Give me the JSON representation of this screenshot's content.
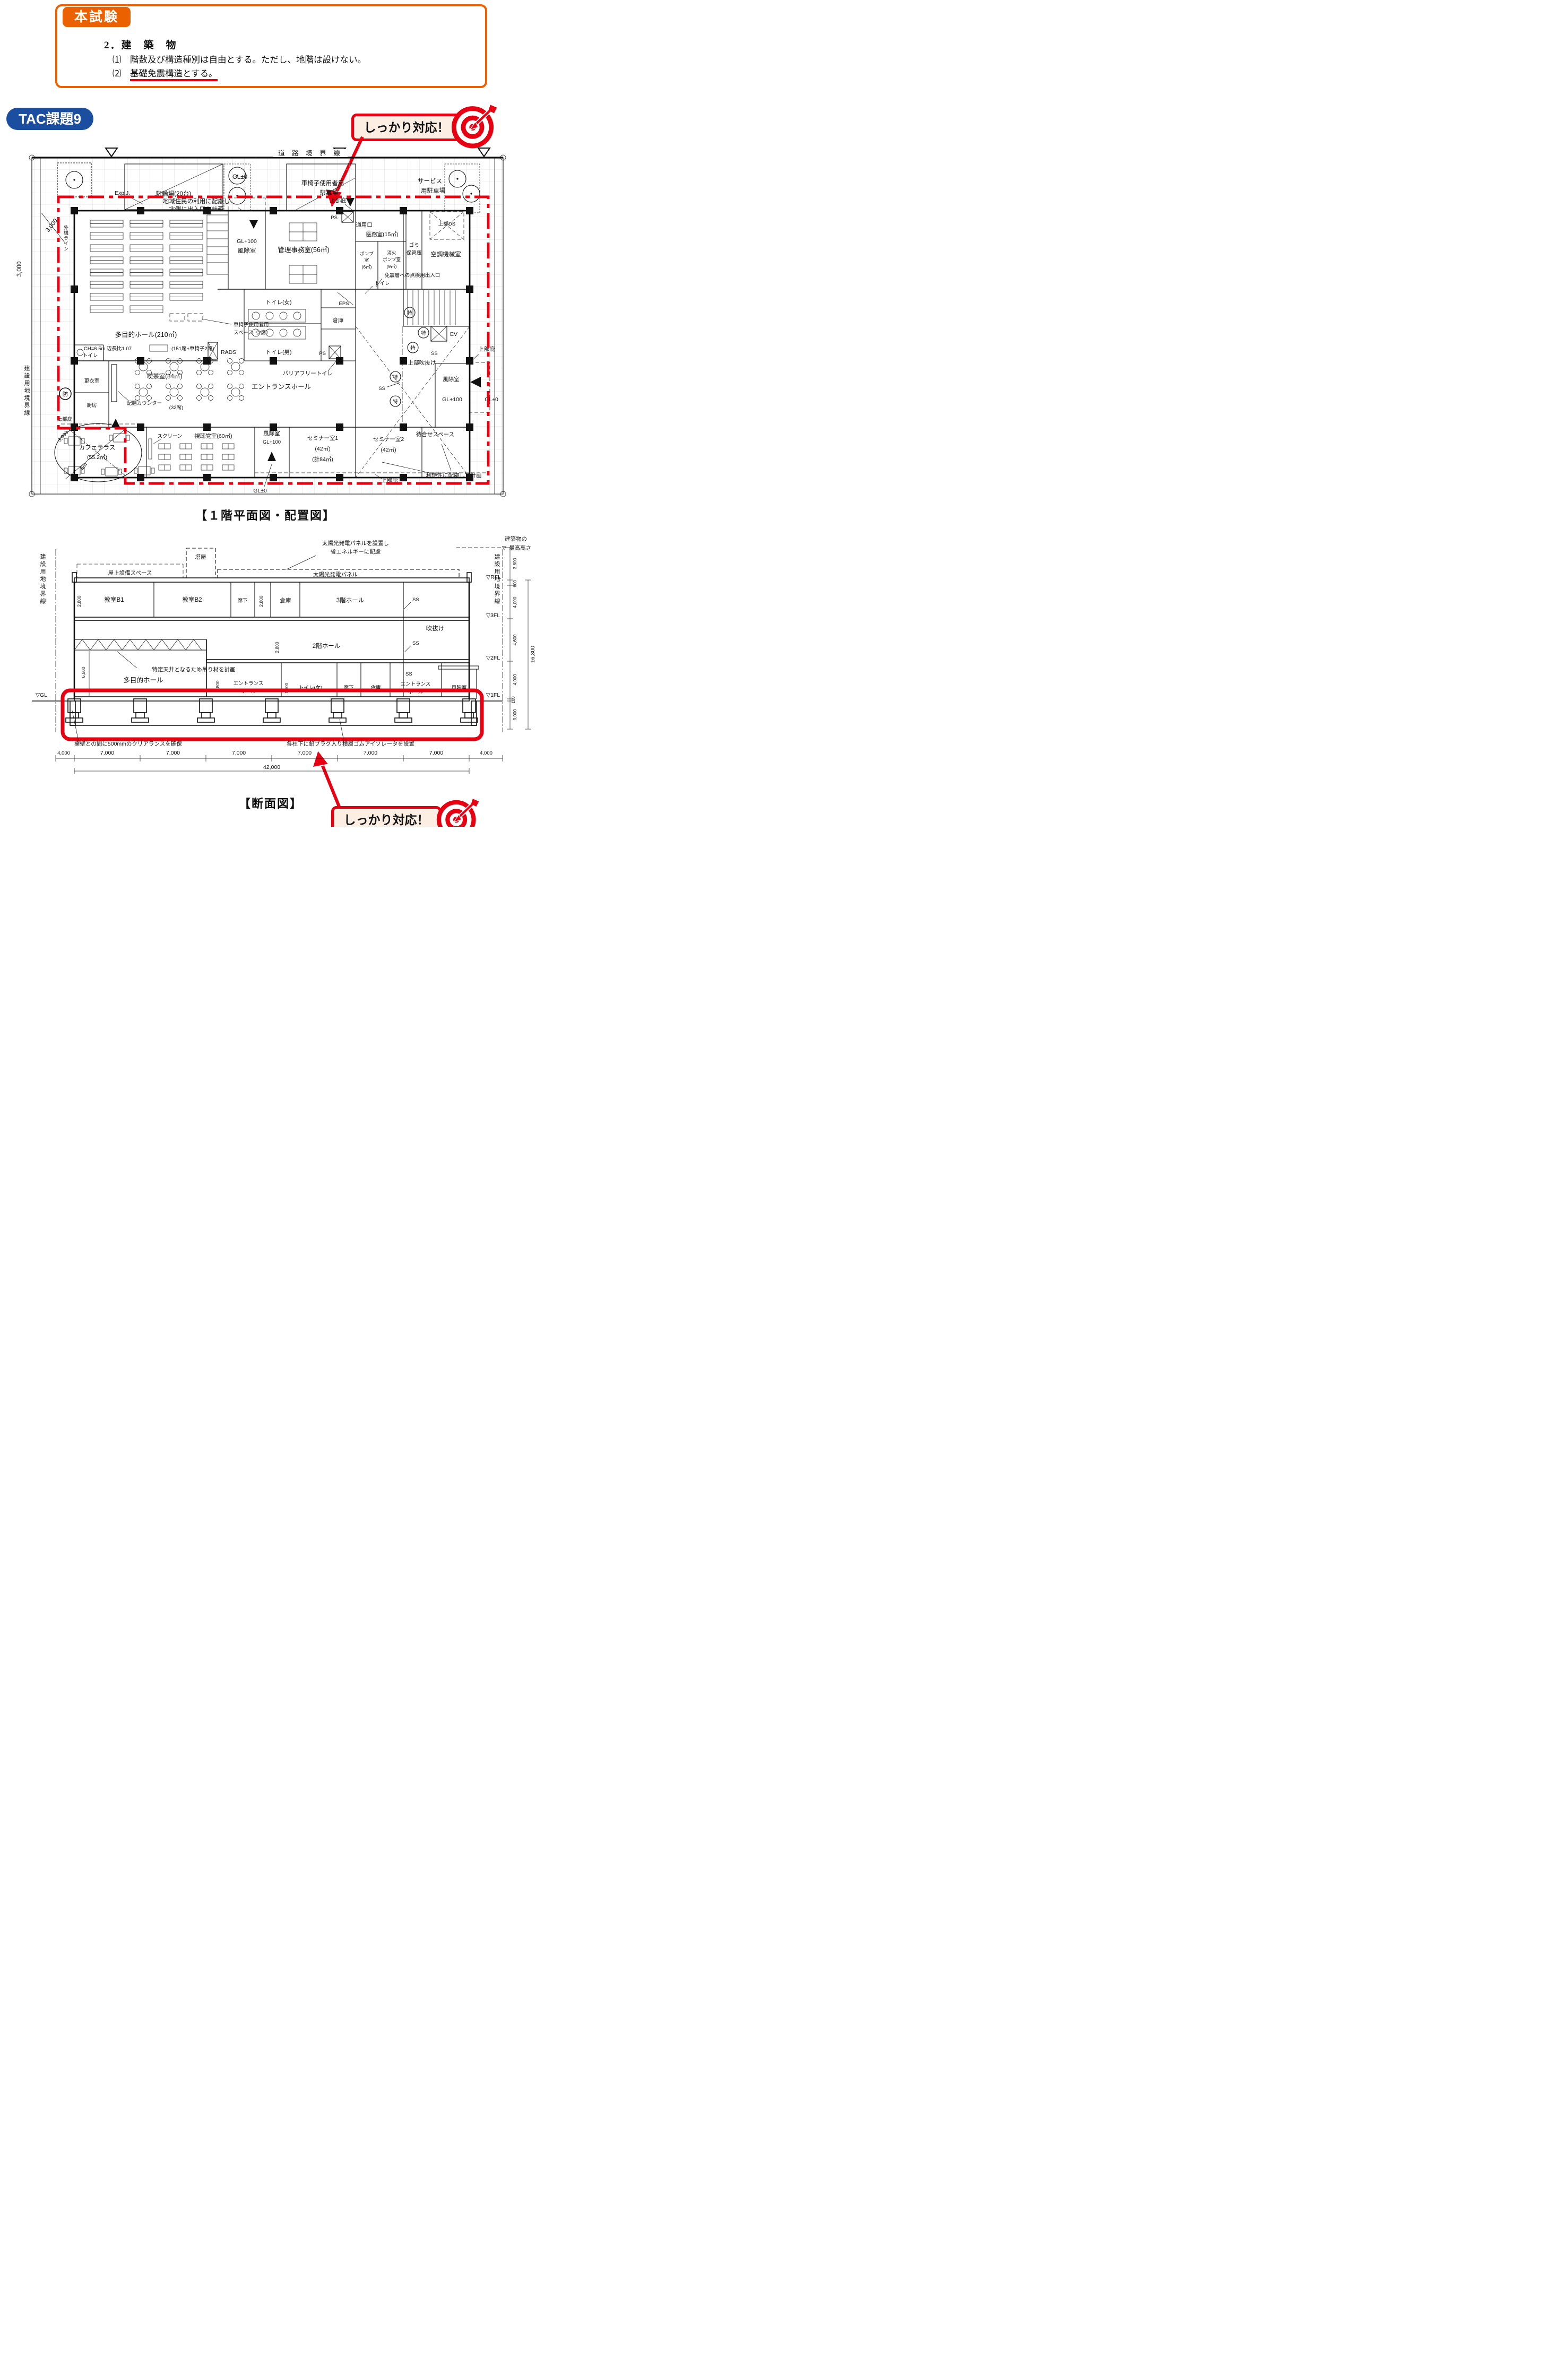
{
  "colors": {
    "orange": "#eb6100",
    "blue": "#1b4e9e",
    "red": "#e60012",
    "cream": "#fdeee4"
  },
  "header": {
    "badge": "本試験",
    "title": "2．建　築　物",
    "item1": "⑴　階数及び構造種別は自由とする。ただし、地階は設けない。",
    "item2_prefix": "⑵　",
    "item2_underlined": "基礎免震構造とする。"
  },
  "badges": {
    "tac": "TAC課題9",
    "callout": "しっかり対応！"
  },
  "shared": {
    "canopy": "上部庇",
    "toku": "特",
    "ss": "SS",
    "gl0": "GL±0",
    "gl100": "GL+100",
    "windbreak": "風除室",
    "storage": "倉庫",
    "corridor": "廊下",
    "ps": "PS",
    "eps": "EPS",
    "ev": "EV",
    "bou": "防",
    "rads": "RADS",
    "toilet": "トイレ",
    "tri": "▽",
    "dim_3000": "3,000",
    "dim_2800": "2,800",
    "dim_4000": "4,000",
    "dim_7000": "7,000",
    "site_boundary": "建設用地境界線",
    "entrance_hall": "エントランスホール"
  },
  "plan": {
    "caption": "【１階平面図・配置図】",
    "road_boundary": "道 路 境 界 線",
    "gaikou": "外構ライン",
    "expj": "Exp.J.",
    "dim_6m": "6m",
    "bicycle": "駐輪場(20台)",
    "wheelchair_parking1": "車椅子使用者用",
    "wheelchair_parking2": "駐車場",
    "service_parking1": "サービス",
    "service_parking2": "用駐車場",
    "north_note1": "地域住民の利用に配慮し",
    "north_note2": "北側に出入口を計画",
    "service_entrance": "通用口",
    "admin": "管理事務室(56㎡)",
    "medical": "医務室(15㎡)",
    "pump1": "ポンプ",
    "pump2": "室",
    "pump3": "(6㎡)",
    "fire1": "消火",
    "fire2": "ポンプ室",
    "fire3": "(9㎡)",
    "garbage1": "ゴミ",
    "garbage2": "保管庫",
    "hvac": "空調機械室",
    "upper_ds": "上部DS",
    "seismic_access": "免震層への点検用出入口",
    "toilet_w": "トイレ(女)",
    "toilet_m": "トイレ(男)",
    "bf_toilet": "バリアフリートイレ",
    "upper_void": "上部吹抜け",
    "hall": "多目的ホール(210㎡)",
    "hall_spec": "CH=6.5m 辺長比1.07",
    "hall_seats": "(151席+車椅子2席)",
    "wc_space1": "車椅子使用者用",
    "wc_space2": "スペース（2席）",
    "changing": "更衣室",
    "kitchen": "厨房",
    "cafe": "喫茶室(84㎡)",
    "counter": "配膳カウンター",
    "counter_seats": "(32席)",
    "terrace1": "カフェテラス",
    "terrace2": "(55.2㎡)",
    "screen": "スクリーン",
    "av": "視聴覚室(60㎡)",
    "seminar1": "セミナー室1",
    "seminar1_a": "(42㎡)",
    "seminar1_b": "(計84㎡)",
    "seminar2": "セミナー室2",
    "seminar2_a": "(42㎡)",
    "waiting": "待合せスペース",
    "convenience": "利便性に配慮して計画"
  },
  "section": {
    "caption": "【断面図】",
    "solar_note1": "太陽光発電パネルを設置し",
    "solar_note2": "省エネルギーに配慮",
    "tower": "塔屋",
    "roof_space": "屋上設備スペース",
    "solar_panel": "太陽光発電パネル",
    "max_height1": "建築物の",
    "max_height2": "最高高さ",
    "b1": "教室B1",
    "b2": "教室B2",
    "hall3": "3階ホール",
    "hall2": "2階ホール",
    "void": "吹抜け",
    "ceiling_note": "特定天井となるため吊り材を計画",
    "hall": "多目的ホール",
    "entrance1": "エントランス",
    "entrance2": "ホール",
    "toilet_w": "トイレ(女)",
    "clearance_note": "擁壁との間に500mmのクリアランスを確保",
    "isolator_note": "各柱下に鉛プラグ入り積層ゴムアイソレータを設置",
    "lv_rfl": "▽RFL",
    "lv_3f": "▽3FL",
    "lv_2f": "▽2FL",
    "lv_1f": "▽1FL",
    "lv_gl": "▽GL",
    "d3600": "3,600",
    "d600": "600",
    "d4600": "4,600",
    "d16300": "16,300",
    "d100": "100",
    "d6500": "6,500",
    "d1500": "1,500",
    "d42000": "42,000"
  }
}
